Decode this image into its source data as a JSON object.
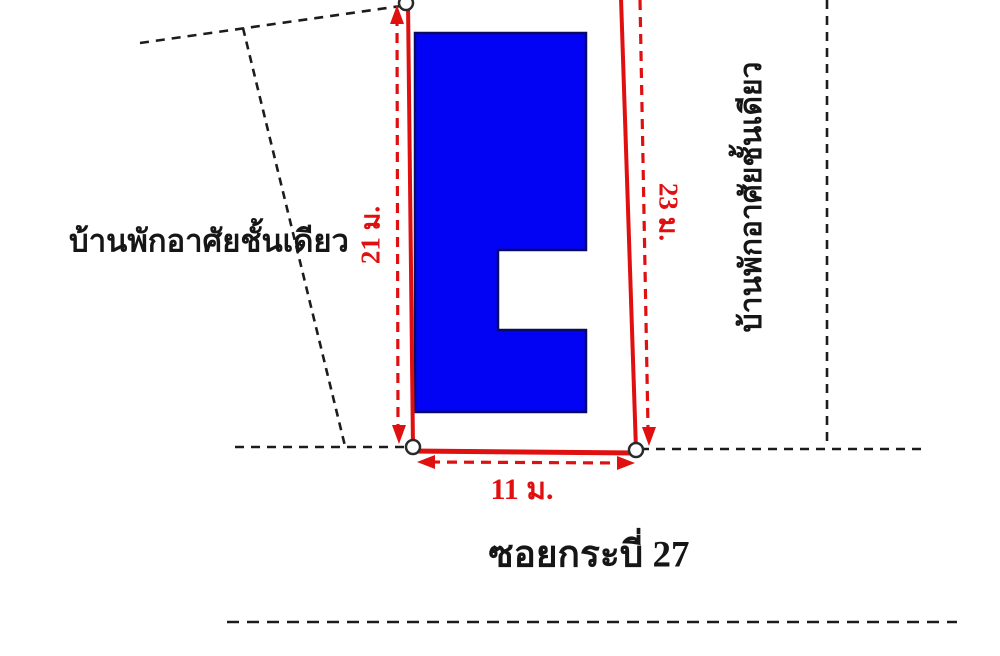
{
  "labels": {
    "left_building": "บ้านพักอาศัยชั้นเดียว",
    "right_building": "บ้านพักอาศัยชั้นเดียว",
    "road": "ซอยกระบี่ 27"
  },
  "dimensions": {
    "west_side": "21 ม.",
    "east_side": "23 ม.",
    "south_side": "11 ม."
  },
  "colors": {
    "boundary_red": "#e01010",
    "building_fill_blue": "#0202f5",
    "building_border_navy": "#0a0a62",
    "dashed_line_black": "#1c1c1c",
    "vertex_marker_fill": "#ffffff",
    "background": "#ffffff"
  }
}
